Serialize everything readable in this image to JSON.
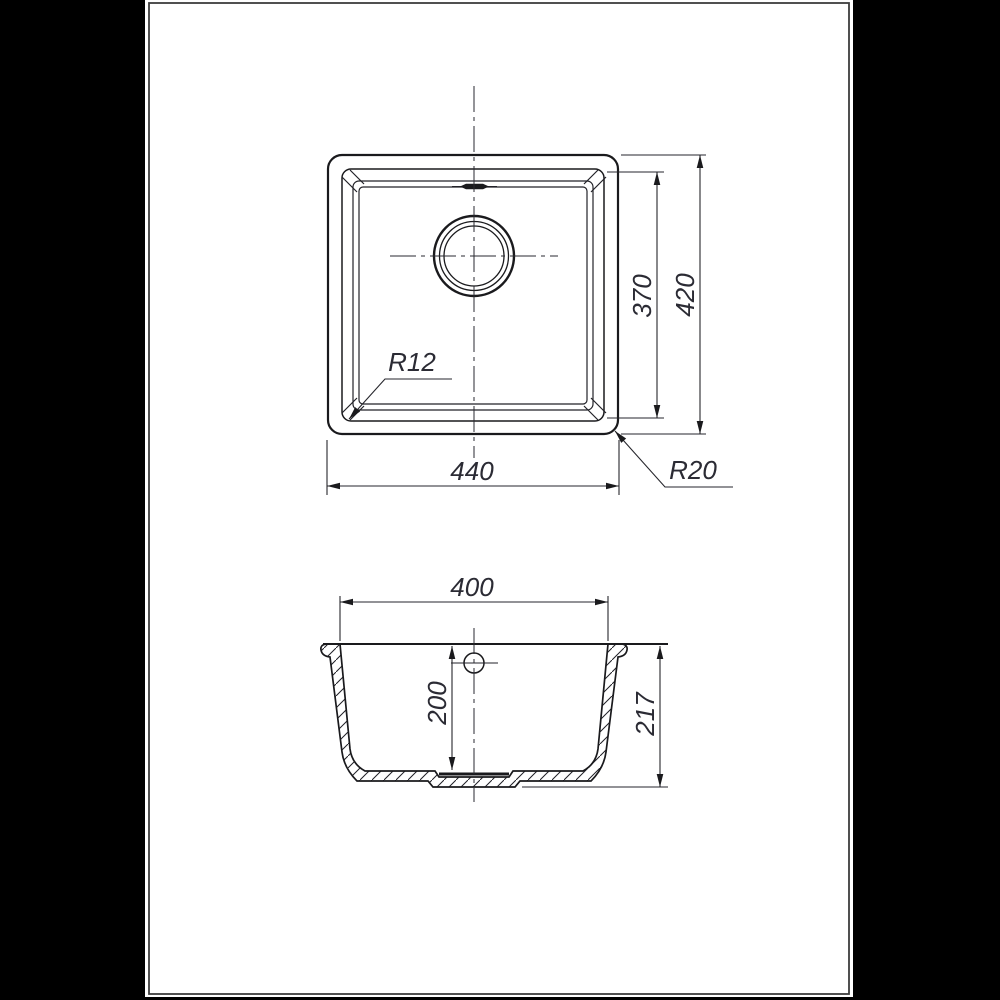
{
  "colors": {
    "background": "#000000",
    "sheet": "#ffffff",
    "sheet_border": "#3d3d3d",
    "line": "#1a1a1d",
    "dimension_text": "#2b2b34"
  },
  "top_view": {
    "dims": {
      "width": "440",
      "inner_height": "370",
      "outer_height": "420",
      "inner_corner_radius": "R12",
      "outer_corner_radius": "R20"
    }
  },
  "section_view": {
    "dims": {
      "top_width": "400",
      "inner_depth": "200",
      "overall_depth": "217"
    }
  }
}
